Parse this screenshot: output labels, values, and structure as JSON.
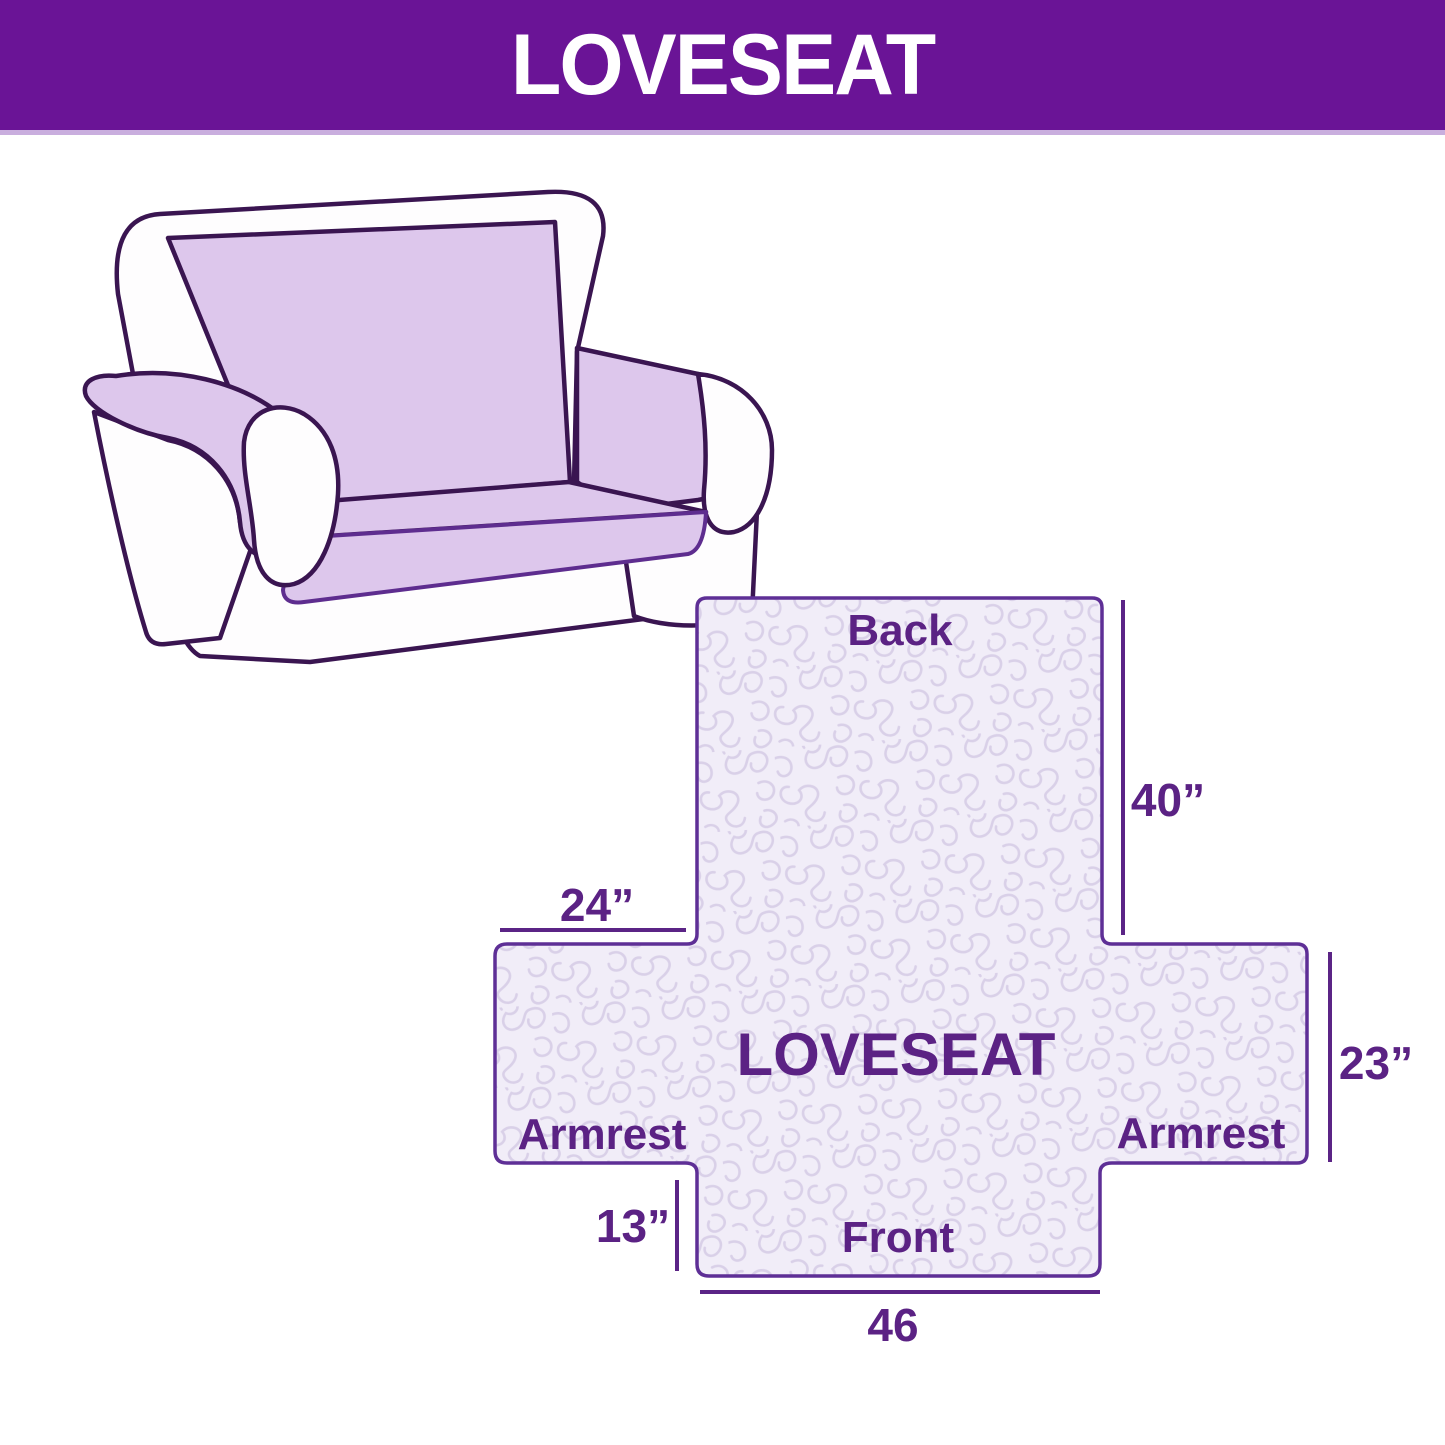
{
  "banner": {
    "title": "LOVESEAT",
    "bg_color": "#6a1496",
    "text_color": "#ffffff"
  },
  "sofa_illustration": {
    "description": "line drawing of a two-seat loveseat with lavender slipcover on back, seat and armrest tops",
    "cover_color": "#ddc7ec",
    "outline_color": "#3a1551"
  },
  "diagram": {
    "center_label": "LOVESEAT",
    "sections": {
      "back": "Back",
      "front": "Front",
      "armrest_left": "Armrest",
      "armrest_right": "Armrest"
    },
    "measurements": {
      "back_height": "40”",
      "back_width": "24”",
      "armrest_height": "23”",
      "front_height": "13”",
      "front_width": "46"
    },
    "fill_color": "#f1edf8",
    "pattern_color": "#d9d0e8",
    "outline_color": "#5e2f96",
    "label_color": "#5b2284",
    "measure_line_color": "#5b2486"
  }
}
